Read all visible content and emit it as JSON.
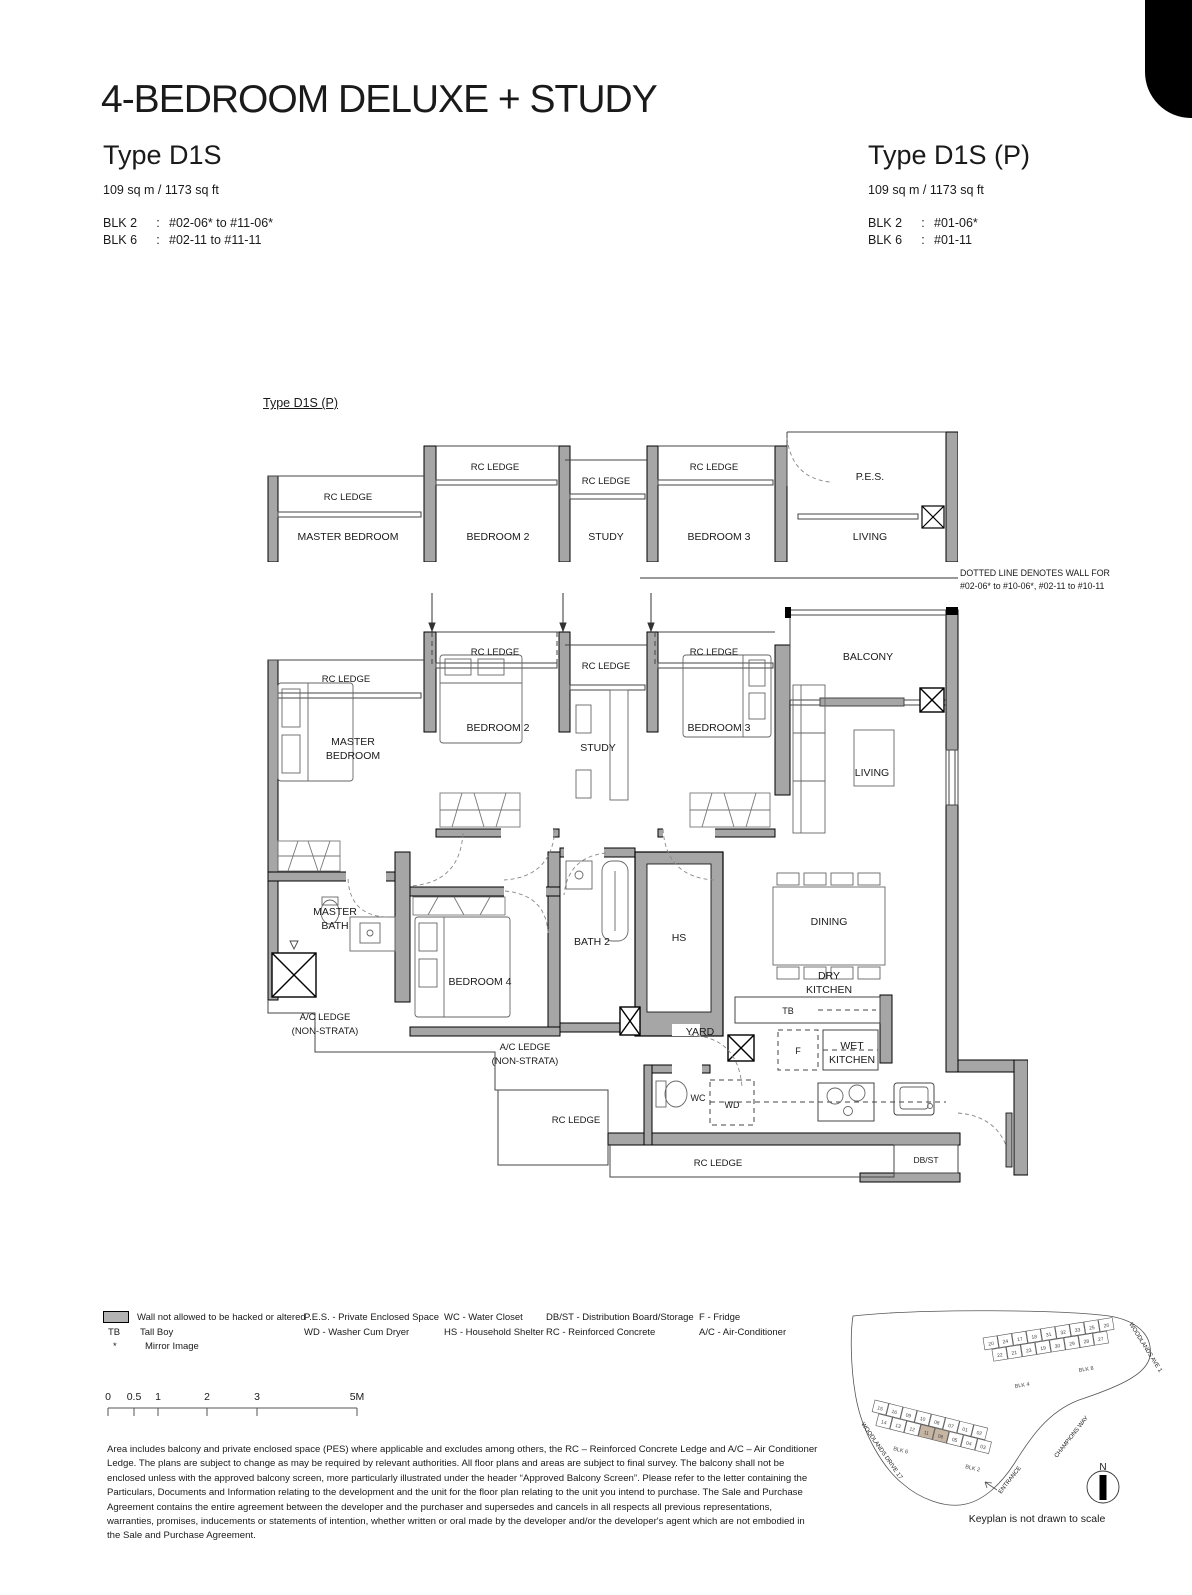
{
  "page": {
    "title": "4-BEDROOM DELUXE + STUDY"
  },
  "left_header": {
    "type": "Type D1S",
    "area": "109 sq m /  1173 sq ft",
    "blk2_label": "BLK 2",
    "colon": ":",
    "blk2_value": "#02-06* to #11-06*",
    "blk6_label": "BLK 6",
    "blk6_value": "#02-11 to #11-11"
  },
  "right_header": {
    "type": "Type D1S (P)",
    "area": "109 sq m /  1173 sq ft",
    "blk2_label": "BLK 2",
    "colon": ":",
    "blk2_value": "#01-06*",
    "blk6_label": "BLK 6",
    "blk6_value": "#01-11"
  },
  "partial_plan": {
    "label": "Type D1S (P)"
  },
  "note": {
    "line1": "DOTTED LINE DENOTES WALL FOR",
    "line2": "#02-06* to #10-06*, #02-11 to #10-11"
  },
  "plan": {
    "rc_ledge": "RC LEDGE",
    "balcony": "BALCONY",
    "pes": "P.E.S.",
    "master_bedroom_l1": "MASTER",
    "master_bedroom_l2": "BEDROOM",
    "master_bedroom_single": "MASTER BEDROOM",
    "bedroom2": "BEDROOM 2",
    "study": "STUDY",
    "bedroom3": "BEDROOM 3",
    "living": "LIVING",
    "master_bath_l1": "MASTER",
    "master_bath_l2": "BATH",
    "bedroom4": "BEDROOM 4",
    "bath2": "BATH 2",
    "hs": "HS",
    "dining": "DINING",
    "dry_l1": "DRY",
    "dry_l2": "KITCHEN",
    "wet_l1": "WET",
    "wet_l2": "KITCHEN",
    "tb": "TB",
    "fridge": "F",
    "yard": "YARD",
    "wc": "WC",
    "wd": "WD",
    "ac_l1": "A/C LEDGE",
    "ac_l2": "(NON-STRATA)",
    "dbst": "DB/ST"
  },
  "legend": {
    "wall": "Wall not allowed to be hacked or altered",
    "tb_sym": "TB",
    "tb": "Tall Boy",
    "mirror_sym": "*",
    "mirror": "Mirror Image",
    "pes": "P.E.S. - Private Enclosed Space",
    "wd": "WD - Washer Cum Dryer",
    "wc": "WC - Water Closet",
    "hs": "HS - Household Shelter",
    "dbst": "DB/ST - Distribution Board/Storage",
    "rc": "RC - Reinforced Concrete",
    "fridge": "F - Fridge",
    "ac": "A/C - Air-Conditioner"
  },
  "scalebar": {
    "ticks": [
      "0",
      "0.5",
      "1",
      "2",
      "3",
      "5M"
    ]
  },
  "disclaimer": "Area includes balcony and private enclosed space (PES) where applicable and excludes among others, the RC – Reinforced Concrete Ledge and A/C – Air Conditioner Ledge. The plans are subject to change as may be required by relevant authorities. All floor plans and areas are subject to final survey. The balcony shall not be enclosed unless with the approved balcony screen, more particularly illustrated under the header “Approved Balcony Screen”. Please refer to the letter containing the Particulars, Documents and Information relating to the development and the unit for the floor plan relating to the unit you intend to purchase. The Sale and Purchase Agreement contains the entire agreement between the developer and the purchaser and supersedes and cancels in all respects all previous representations, warranties, promises, inducements or statements of intention, whether written or oral made by the developer and/or the developer's agent which are not embodied in the Sale and Purchase Agreement.",
  "keyplan": {
    "caption": "Keyplan is not drawn to scale",
    "north": "N",
    "streets": {
      "woodlands_ave": "WOODLANDS AVE 1",
      "champions_way": "CHAMPIONS WAY",
      "entrance": "ENTRANCE",
      "woodlands_drive": "WOODLANDS DRIVE 17"
    },
    "highlight": [
      "11",
      "06"
    ],
    "unit_fill": "#ffffff",
    "hl_fill": "#c7b5a4",
    "clusters": [
      {
        "angle": -9,
        "ox": 150,
        "oy": 66,
        "rows": [
          [
            "20",
            "24",
            "17",
            "18",
            "31",
            "32",
            "33",
            "25",
            "26"
          ],
          [
            "22",
            "21",
            "23",
            "19",
            "30",
            "29",
            "28",
            "27"
          ]
        ]
      },
      {
        "angle": 14,
        "ox": 42,
        "oy": 128,
        "rows": [
          [
            "15",
            "16",
            "09",
            "10",
            "08",
            "07",
            "01",
            "02"
          ],
          [
            "14",
            "13",
            "12",
            "11",
            "06",
            "05",
            "04",
            "03"
          ]
        ]
      }
    ],
    "blocks": [
      {
        "t": "BLK 4",
        "x": 182,
        "y": 116,
        "r": -9
      },
      {
        "t": "BLK 8",
        "x": 246,
        "y": 100,
        "r": -9
      },
      {
        "t": "BLK 6",
        "x": 60,
        "y": 178,
        "r": 14
      },
      {
        "t": "BLK 2",
        "x": 132,
        "y": 196,
        "r": 14
      }
    ]
  }
}
